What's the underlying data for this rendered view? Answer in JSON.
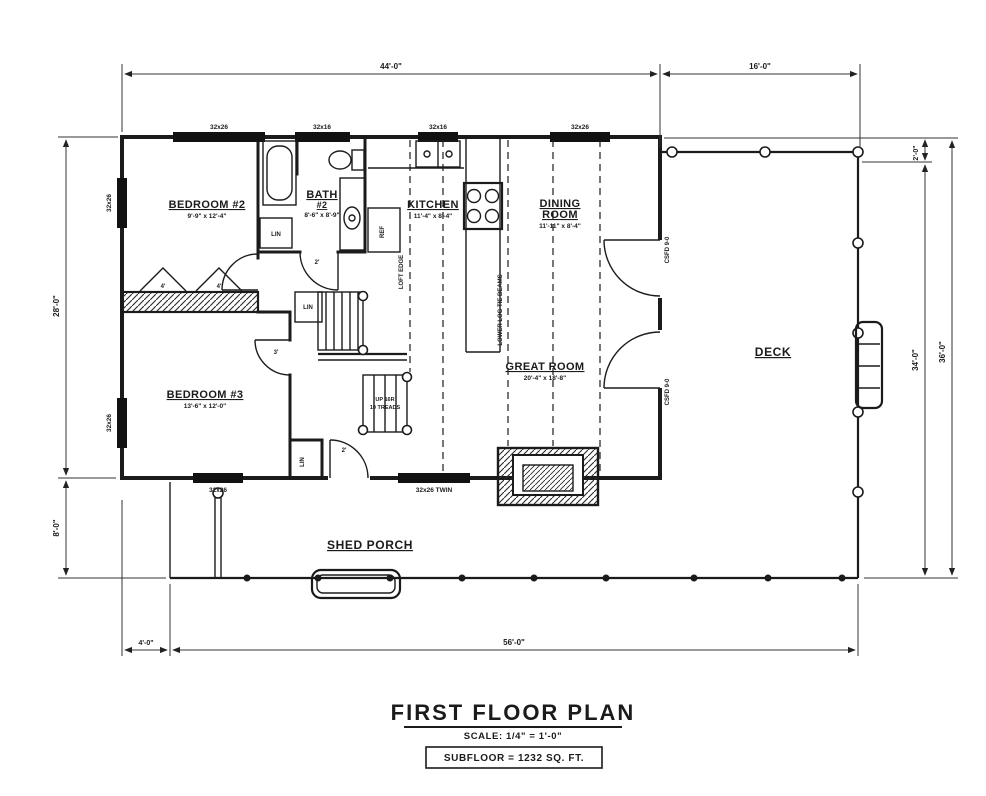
{
  "rooms": {
    "bedroom2_label": "BEDROOM #2",
    "bedroom2_dims": "9'-9\" x 12'-4\"",
    "bath_label": "BATH",
    "bath_num": "#2",
    "bath_dims": "8'-6\" x 8'-9\"",
    "kitchen_label": "KITCHEN",
    "kitchen_dims": "11'-4\" x 8'-4\"",
    "dining_label1": "DINING",
    "dining_label2": "ROOM",
    "dining_dims": "11'-11\" x 8'-4\"",
    "great_label": "GREAT ROOM",
    "great_dims": "20'-4\" x 18'-8\"",
    "bedroom3_label": "BEDROOM #3",
    "bedroom3_dims": "13'-6\" x 12'-0\"",
    "deck_label": "DECK",
    "porch_label": "SHED PORCH"
  },
  "dimensions": {
    "top_main": "44'-0\"",
    "top_deck": "16'-0\"",
    "right_gap": "2'-0\"",
    "right_inner": "34'-0\"",
    "right_outer": "36'-0\"",
    "left_main": "28'-0\"",
    "left_porch": "8'-0\"",
    "bottom_offset": "4'-0\"",
    "bottom_main": "56'-0\""
  },
  "windows": {
    "w_top1": "32x26",
    "w_top2": "32x16",
    "w_top3": "32x16",
    "w_top4": "32x26",
    "w_left1": "32x26",
    "w_left2": "32x26",
    "w_bottom1": "32x26",
    "w_bottom2": "32x26 TWIN"
  },
  "annotations": {
    "tie_beams": "LOWER LOG TIE BEAMS",
    "loft_edge": "LOFT EDGE",
    "csfd_1": "CSFD 9-0",
    "csfd_2": "CSFD 9-0",
    "stair_note1": "UP 16R",
    "stair_note2": "10 TREADS",
    "ref": "REF",
    "lin_bath": "LIN",
    "lin_hall": "LIN",
    "lin_bed3": "LIN",
    "d4a": "4'",
    "d4b": "4'",
    "d2a": "2'",
    "d2b": "2'",
    "d3a": "3'"
  },
  "title_block": {
    "title": "FIRST FLOOR PLAN",
    "scale": "SCALE: 1/4\" = 1'-0\"",
    "subfloor": "SUBFLOOR = 1232 SQ. FT."
  }
}
